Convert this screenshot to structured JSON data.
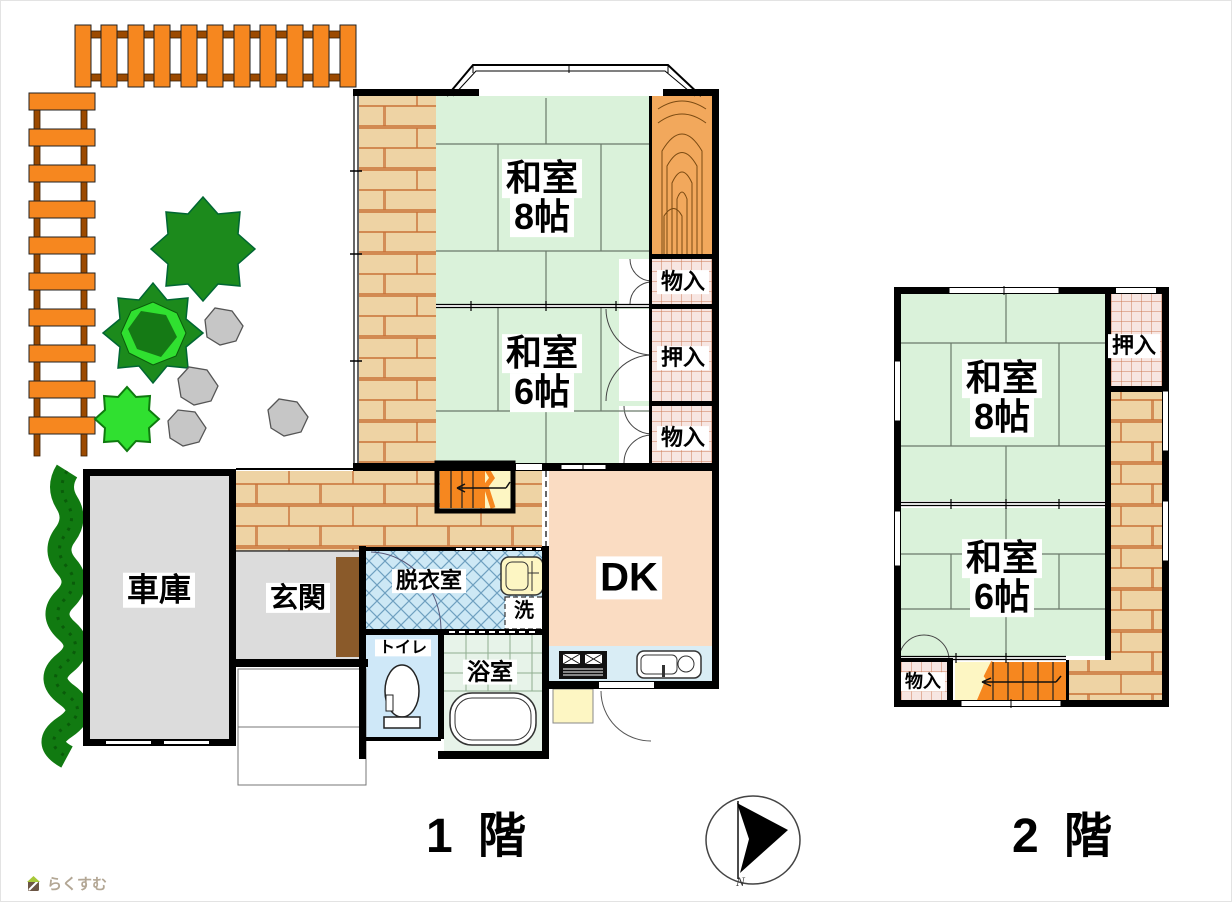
{
  "floor1": {
    "caption": "1 階",
    "rooms": {
      "washitsu8": {
        "name": "和室",
        "size": "8帖"
      },
      "washitsu6": {
        "name": "和室",
        "size": "6帖"
      },
      "storage_top": "物入",
      "oshiire": "押入",
      "storage_bottom": "物入",
      "garage": "車庫",
      "genkan": "玄関",
      "datsuishitsu": "脱衣室",
      "laundry": "洗",
      "toilet": "トイレ",
      "bathroom": "浴室",
      "dk": "DK"
    }
  },
  "floor2": {
    "caption": "2 階",
    "rooms": {
      "washitsu8": {
        "name": "和室",
        "size": "8帖"
      },
      "washitsu6": {
        "name": "和室",
        "size": "6帖"
      },
      "oshiire": "押入",
      "storage": "物入"
    }
  },
  "compass": {
    "label": "N"
  },
  "watermark": {
    "text": "らくすむ"
  },
  "colors": {
    "tatami": "#daf2da",
    "tatami_line": "#6a7a6a",
    "wood_floor": "#eed3a4",
    "wood_line": "#c87137",
    "fence_orange": "#f6871f",
    "fence_rail": "#9c4a00",
    "closet_bg": "#f7e6e2",
    "closet_line": "#cc7a55",
    "dk_floor": "#fadcc2",
    "gray_room": "#dcdcdc",
    "datsui_blue": "#cde8f5",
    "toilet_blue": "#cfe8f8",
    "bath_green": "#e7f3e9",
    "counter_blue": "#d9edf5",
    "step_yellow": "#fdf6c3",
    "stair_orange": "#f6871f",
    "tokonoma": "#f2a85c",
    "tree_dark": "#1c8a1c",
    "tree_light": "#30e030",
    "hedge_green": "#117a11",
    "rock_gray": "#c6c6c6",
    "step_brown": "#8a5a2a"
  }
}
